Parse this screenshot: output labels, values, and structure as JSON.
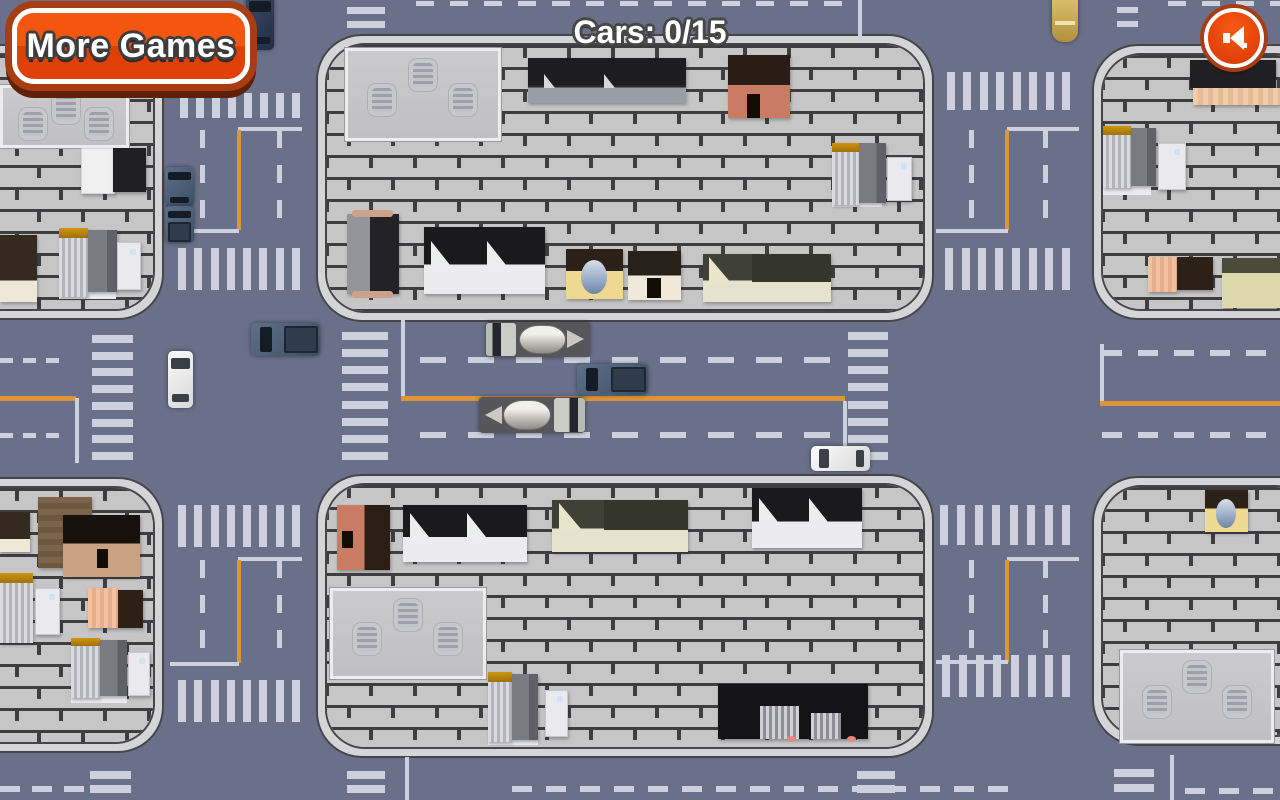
{
  "hud": {
    "more_games_label": "More Games",
    "cars_counter_text": "Cars: 0/15",
    "sound_icon": "speaker-icon"
  },
  "palette": {
    "road": "#6a708a",
    "block_fill": "#c6c6c6",
    "block_mortar": "#3e3e40",
    "sidewalk_rim": "#d5d5d7",
    "marking_white": "#ccd1dd",
    "marking_orange": "#dc9637",
    "button_orange": "#ee4b0d",
    "button_ring_white": "#ffffff",
    "button_border_brown": "#a83c12",
    "text_white": "#ffffff",
    "text_outline_gray": "#474747"
  },
  "map": {
    "blocks": [
      [
        -60,
        44,
        220,
        272
      ],
      [
        316,
        34,
        614,
        284
      ],
      [
        1092,
        44,
        228,
        272
      ],
      [
        -60,
        477,
        220,
        272
      ],
      [
        316,
        474,
        614,
        280
      ],
      [
        1092,
        476,
        228,
        266
      ]
    ],
    "crosswalks": [
      [
        180,
        93,
        120,
        25,
        "row",
        8
      ],
      [
        178,
        248,
        122,
        42,
        "row",
        8
      ],
      [
        178,
        505,
        122,
        42,
        "row",
        8
      ],
      [
        178,
        680,
        122,
        42,
        "row",
        8
      ],
      [
        947,
        72,
        123,
        38,
        "row",
        8
      ],
      [
        945,
        248,
        125,
        42,
        "row",
        8
      ],
      [
        940,
        505,
        130,
        40,
        "row",
        8
      ],
      [
        942,
        655,
        128,
        42,
        "row",
        8
      ],
      [
        342,
        332,
        46,
        128,
        "col",
        8
      ],
      [
        848,
        332,
        40,
        128,
        "col",
        8
      ],
      [
        92,
        335,
        41,
        125,
        "col",
        8
      ]
    ],
    "dashes": [
      [
        416,
        1,
        "h",
        434,
        18,
        16,
        5
      ],
      [
        1168,
        1,
        "h",
        112,
        18,
        16,
        5
      ],
      [
        200,
        130,
        "v",
        98,
        18,
        17,
        5
      ],
      [
        277,
        130,
        "v",
        98,
        18,
        17,
        5
      ],
      [
        200,
        560,
        "v",
        103,
        18,
        17,
        5
      ],
      [
        277,
        560,
        "v",
        103,
        18,
        17,
        5
      ],
      [
        969,
        130,
        "v",
        98,
        18,
        17,
        5
      ],
      [
        1043,
        130,
        "v",
        98,
        18,
        17,
        5
      ],
      [
        969,
        560,
        "v",
        100,
        18,
        17,
        5
      ],
      [
        1043,
        560,
        "v",
        100,
        18,
        17,
        5
      ],
      [
        420,
        357,
        "h",
        425,
        26,
        22,
        6
      ],
      [
        420,
        432,
        "h",
        425,
        26,
        22,
        6
      ],
      [
        0,
        358,
        "h",
        66,
        13,
        10,
        5
      ],
      [
        0,
        433,
        "h",
        66,
        13,
        10,
        5
      ],
      [
        1102,
        350,
        "h",
        178,
        20,
        16,
        6
      ],
      [
        1102,
        432,
        "h",
        178,
        20,
        16,
        6
      ],
      [
        0,
        786,
        "h",
        88,
        20,
        12,
        6
      ],
      [
        512,
        786,
        "h",
        500,
        20,
        14,
        6
      ],
      [
        1185,
        788,
        "h",
        95,
        20,
        14,
        6
      ]
    ],
    "solids": [
      [
        858,
        0,
        4,
        40,
        "w"
      ],
      [
        238,
        127,
        64,
        4,
        "w"
      ],
      [
        237,
        130,
        4,
        100,
        "o"
      ],
      [
        176,
        229,
        63,
        4,
        "w"
      ],
      [
        1007,
        127,
        72,
        4,
        "w"
      ],
      [
        1005,
        130,
        4,
        100,
        "o"
      ],
      [
        936,
        229,
        72,
        4,
        "w"
      ],
      [
        401,
        320,
        4,
        78,
        "w"
      ],
      [
        401,
        396,
        444,
        5,
        "o"
      ],
      [
        843,
        401,
        4,
        62,
        "w"
      ],
      [
        0,
        396,
        76,
        5,
        "o"
      ],
      [
        75,
        398,
        4,
        65,
        "w"
      ],
      [
        1100,
        344,
        4,
        57,
        "w"
      ],
      [
        1100,
        401,
        180,
        5,
        "o"
      ],
      [
        238,
        557,
        64,
        4,
        "w"
      ],
      [
        237,
        560,
        4,
        103,
        "o"
      ],
      [
        170,
        662,
        69,
        4,
        "w"
      ],
      [
        1007,
        557,
        72,
        4,
        "w"
      ],
      [
        1005,
        560,
        4,
        102,
        "o"
      ],
      [
        936,
        660,
        72,
        4,
        "w"
      ],
      [
        405,
        757,
        4,
        43,
        "w"
      ],
      [
        1170,
        755,
        4,
        45,
        "w"
      ],
      [
        347,
        7,
        38,
        7,
        "w"
      ],
      [
        347,
        21,
        38,
        7,
        "w"
      ],
      [
        1117,
        7,
        21,
        6,
        "w"
      ],
      [
        1117,
        21,
        21,
        6,
        "w"
      ],
      [
        90,
        771,
        41,
        8,
        "w"
      ],
      [
        90,
        785,
        41,
        8,
        "w"
      ],
      [
        347,
        771,
        38,
        8,
        "w"
      ],
      [
        347,
        785,
        38,
        8,
        "w"
      ],
      [
        857,
        771,
        38,
        8,
        "w"
      ],
      [
        857,
        785,
        38,
        8,
        "w"
      ],
      [
        1114,
        769,
        40,
        8,
        "w"
      ],
      [
        1114,
        784,
        40,
        8,
        "w"
      ]
    ],
    "buildings": [
      [
        "wh",
        0,
        85,
        123,
        57
      ],
      [
        "white-box",
        81,
        148,
        32,
        44
      ],
      [
        "dark-box",
        113,
        148,
        33,
        44
      ],
      [
        "darkbrown-cream",
        0,
        235,
        37,
        67
      ],
      [
        "white-strip",
        59,
        290,
        57,
        9
      ],
      [
        "gray-unit-gold",
        59,
        228,
        29,
        69
      ],
      [
        "dark-unit",
        88,
        230,
        29,
        62
      ],
      [
        "door-unit",
        117,
        242,
        22,
        46
      ],
      [
        "wh",
        345,
        48,
        150,
        87
      ],
      [
        "dark-long",
        528,
        58,
        158,
        45
      ],
      [
        "red-house",
        728,
        55,
        62,
        63
      ],
      [
        "white-strip",
        832,
        198,
        50,
        9
      ],
      [
        "gray-unit-gold",
        832,
        143,
        27,
        62
      ],
      [
        "dark-unit",
        859,
        143,
        27,
        60
      ],
      [
        "door-unit",
        887,
        157,
        23,
        42
      ],
      [
        "barn-dark",
        347,
        214,
        52,
        80
      ],
      [
        "factory",
        424,
        227,
        121,
        67
      ],
      [
        "dome-shop",
        566,
        249,
        57,
        50
      ],
      [
        "cream-shop",
        628,
        251,
        53,
        49
      ],
      [
        "olive-long",
        703,
        254,
        128,
        48
      ],
      [
        "dark-box",
        1190,
        60,
        86,
        28
      ],
      [
        "peach-strip",
        1193,
        88,
        87,
        17
      ],
      [
        "white-strip",
        1103,
        186,
        48,
        9
      ],
      [
        "gray-unit-gold",
        1103,
        126,
        28,
        62
      ],
      [
        "dark-unit",
        1131,
        128,
        25,
        58
      ],
      [
        "door-unit",
        1158,
        143,
        26,
        45
      ],
      [
        "peach-box",
        1148,
        257,
        29,
        35
      ],
      [
        "darkbrown-box",
        1177,
        257,
        36,
        33
      ],
      [
        "khaki-L",
        1222,
        258,
        58,
        50
      ],
      [
        "darkbrown-cream",
        0,
        512,
        30,
        40
      ],
      [
        "brown-wood",
        38,
        497,
        54,
        71
      ],
      [
        "black-tan",
        63,
        515,
        77,
        62
      ],
      [
        "gray-unit-gold",
        0,
        573,
        33,
        70
      ],
      [
        "door-unit",
        35,
        588,
        23,
        45
      ],
      [
        "peach-box",
        88,
        588,
        30,
        40
      ],
      [
        "darkbrown-box",
        118,
        590,
        25,
        38
      ],
      [
        "white-strip",
        71,
        694,
        56,
        9
      ],
      [
        "gray-unit-gold",
        71,
        638,
        29,
        60
      ],
      [
        "dark-unit",
        100,
        640,
        27,
        56
      ],
      [
        "door-unit",
        128,
        652,
        20,
        42
      ],
      [
        "red-house2",
        337,
        505,
        53,
        65
      ],
      [
        "factory",
        403,
        505,
        124,
        57
      ],
      [
        "olive-long",
        552,
        500,
        136,
        52
      ],
      [
        "factory",
        752,
        488,
        110,
        60
      ],
      [
        "wh",
        330,
        588,
        150,
        85
      ],
      [
        "white-strip",
        488,
        736,
        50,
        9
      ],
      [
        "gray-unit-gold",
        488,
        672,
        24,
        70
      ],
      [
        "dark-unit",
        512,
        674,
        26,
        66
      ],
      [
        "door-unit",
        545,
        690,
        21,
        45
      ],
      [
        "black-complex",
        718,
        684,
        150,
        55
      ],
      [
        "dome-shop",
        1205,
        490,
        43,
        42
      ],
      [
        "wh",
        1120,
        650,
        148,
        87
      ]
    ],
    "vehicles": [
      [
        "sedan",
        "navy",
        "v",
        246,
        -6,
        28,
        56
      ],
      [
        "bus",
        "tan",
        "v",
        1052,
        -4,
        26,
        46
      ],
      [
        "sedan",
        "steel",
        "v",
        165,
        167,
        29,
        40
      ],
      [
        "pickup",
        "steel",
        "v",
        165,
        206,
        29,
        37
      ],
      [
        "sedan",
        "white",
        "v",
        168,
        351,
        25,
        57
      ],
      [
        "pickup",
        "steel",
        "h",
        251,
        323,
        69,
        33
      ],
      [
        "cement",
        "gray",
        "hf",
        486,
        322,
        104,
        35
      ],
      [
        "pickup",
        "steel",
        "h",
        577,
        364,
        71,
        31
      ],
      [
        "cement",
        "gray",
        "h",
        479,
        397,
        106,
        36
      ],
      [
        "sedan",
        "white",
        "h",
        811,
        446,
        59,
        25
      ]
    ]
  }
}
